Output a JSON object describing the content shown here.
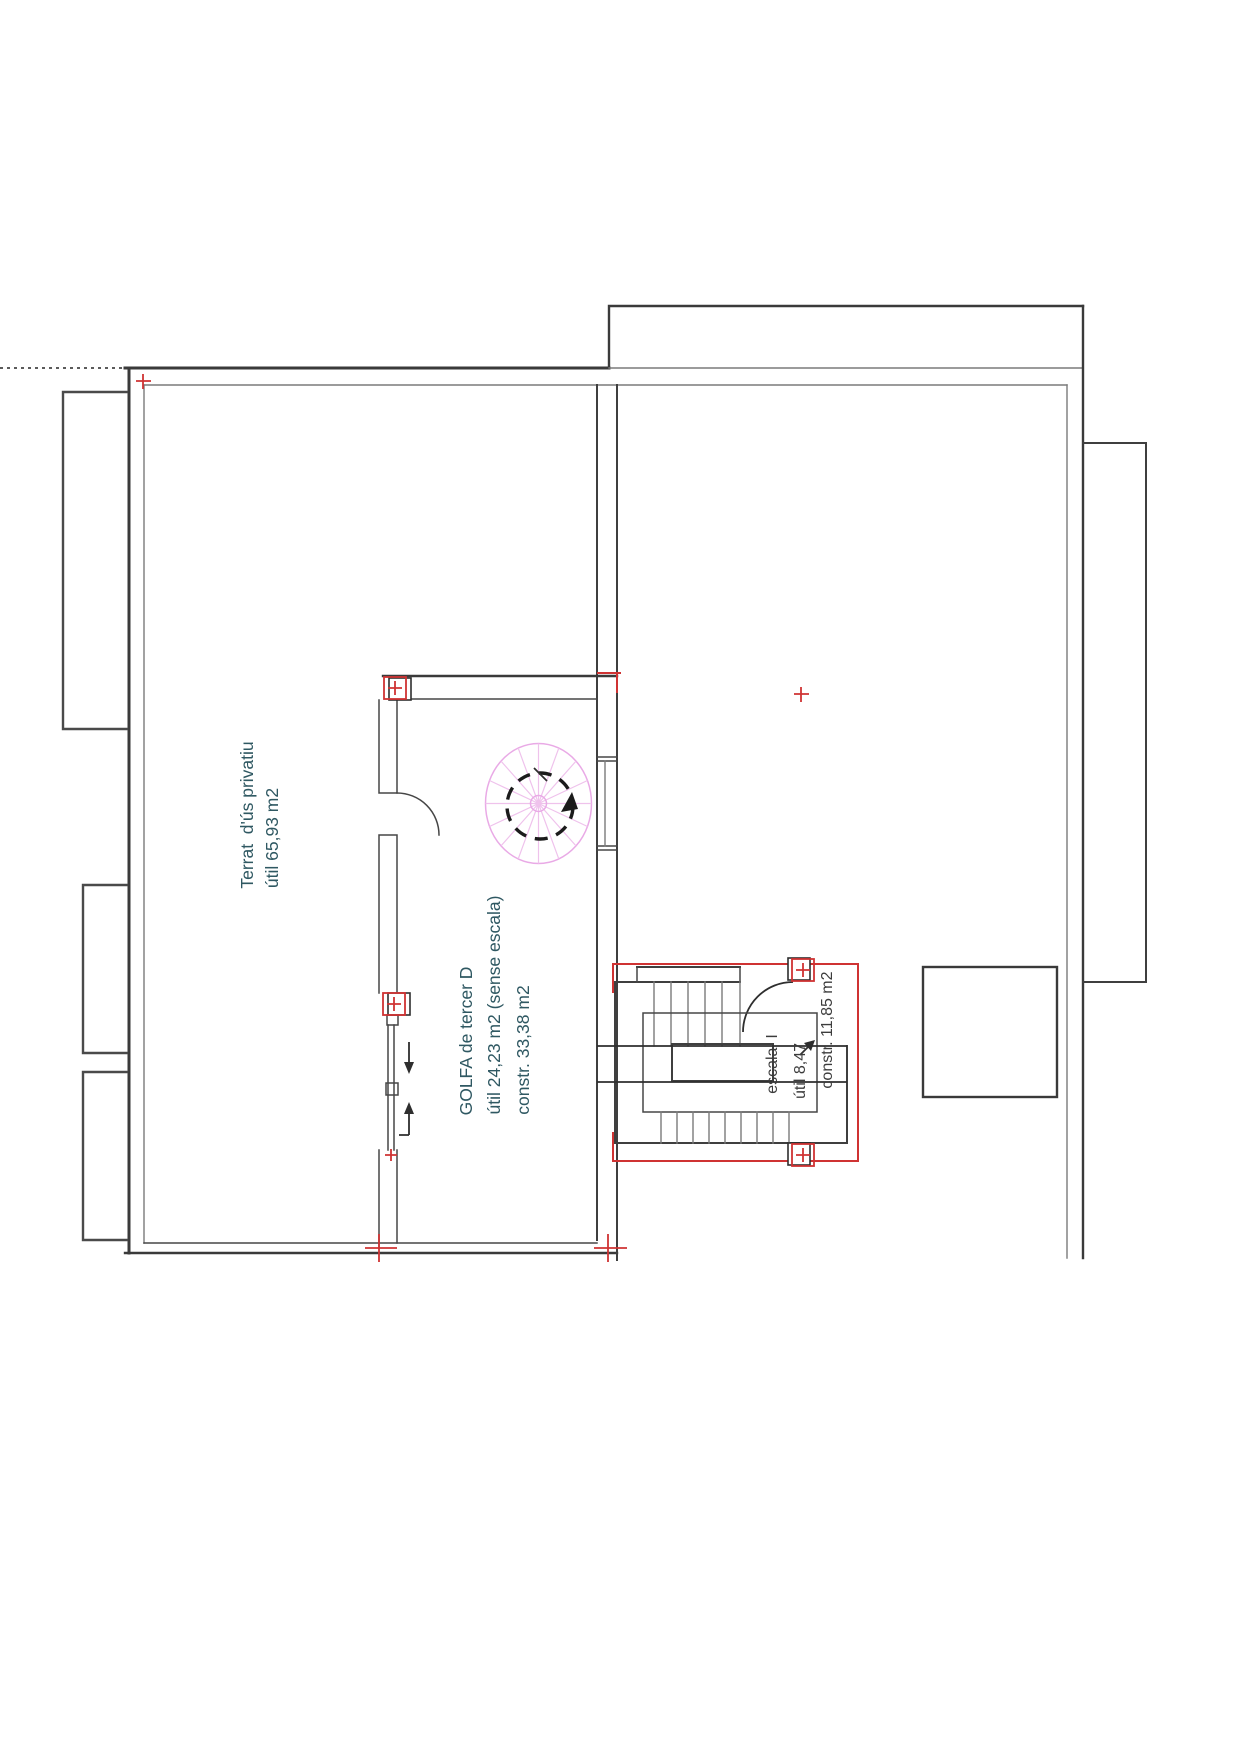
{
  "plan": {
    "type": "architectural-floor-plan",
    "language": "Catalan",
    "labels": {
      "terrat_line1": "Terrat  d'ús privatiu",
      "terrat_line2": "útil 65,93 m2",
      "golfa_line1": "GOLFA de tercer D",
      "golfa_line2": "útil 24,23 m2 (sense escala)",
      "golfa_line3": "constr. 33,38 m2",
      "escala_line1": "escala  I",
      "escala_line2": "útil 8,47",
      "escala_line3": "constr. 11,85 m2"
    },
    "rooms": [
      {
        "name": "Terrat d'ús privatiu",
        "area_util_m2": "65,93"
      },
      {
        "name": "GOLFA de tercer D",
        "area_util_m2": "24,23",
        "area_constr_m2": "33,38",
        "note": "sense escala"
      },
      {
        "name": "escala I",
        "area_util_m2": "8,47",
        "area_constr_m2": "11,85"
      }
    ],
    "colors": {
      "wall": "#3a3a3a",
      "wall_light": "#7a7a7a",
      "annotation_text": "#2f5862",
      "stair_text": "#3c3c3c",
      "marker_red": "#cf3333",
      "spiral_pink": "#e9aae6",
      "background": "#ffffff"
    },
    "features": {
      "spiral_stair": "spiral staircase with dashed direction circle",
      "stair_u": "U-shaped stair with landing and well",
      "balconies": 3,
      "red_survey_markers": "corner squares with plus signs and cross ticks"
    }
  }
}
